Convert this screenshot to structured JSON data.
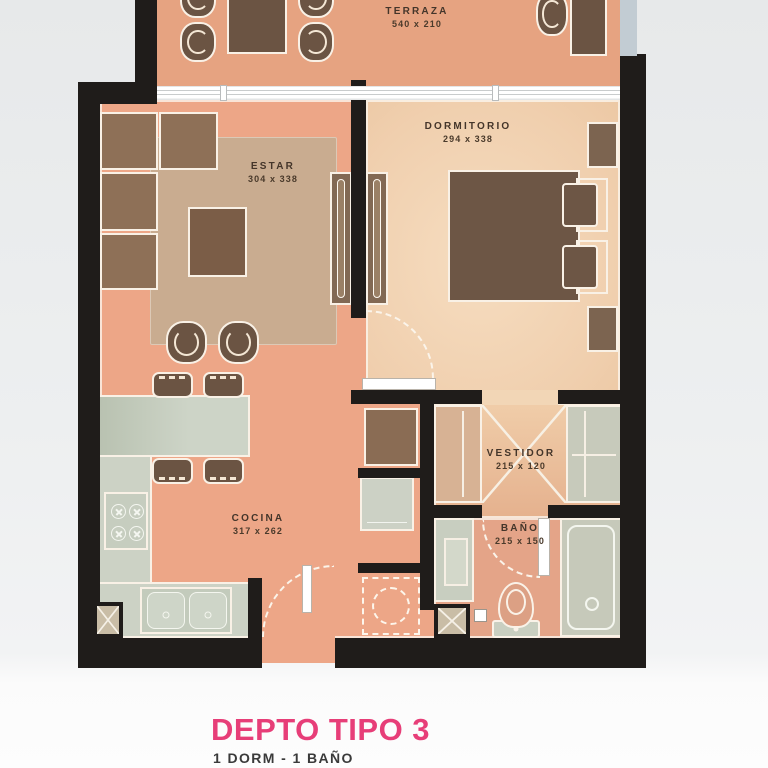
{
  "title": {
    "text": "DEPTO TIPO 3",
    "subtitle": "1 DORM - 1 BAÑO"
  },
  "rooms": {
    "terraza": {
      "label": "TERRAZA",
      "dims": "540 x 210"
    },
    "estar": {
      "label": "ESTAR",
      "dims": "304 x 338"
    },
    "dormitorio": {
      "label": "DORMITORIO",
      "dims": "294 x 338"
    },
    "cocina": {
      "label": "COCINA",
      "dims": "317 x 262"
    },
    "vestidor": {
      "label": "VESTIDOR",
      "dims": "215 x 120"
    },
    "bano": {
      "label": "BAÑO",
      "dims": "215 x 150"
    }
  },
  "colors": {
    "accent_pink": "#e73e78",
    "wall_black": "#1f1c1a",
    "floor_salmon": "#eda687",
    "floor_terrace": "#e6a381",
    "floor_bedroom": "#f2d3b3",
    "floor_vestidor": "#e9bd9e",
    "floor_bath": "#e4a488",
    "counter_green": "#ccd2c5",
    "furniture_brown": "#6b5443",
    "glass_railing": "#c2ccd3"
  }
}
